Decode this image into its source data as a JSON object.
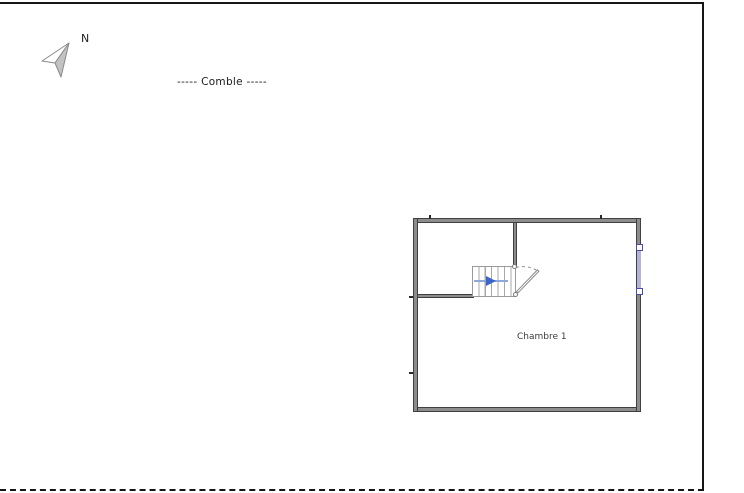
{
  "canvas": {
    "background": "#ffffff",
    "frame_color": "#161616"
  },
  "compass": {
    "label": "N"
  },
  "floor": {
    "title": "----- Comble -----"
  },
  "plan": {
    "rooms": [
      {
        "name": "Chambre 1"
      }
    ],
    "colors": {
      "wall_fill": "#8c8c8c",
      "wall_edge": "#404040",
      "stair_tread": "#a8a8a8",
      "stair_arrow_blue": "#3a66cc",
      "window_fill": "#b4b4d8",
      "window_handle_border": "#4d4da8",
      "door_stroke": "#8a8a8a"
    }
  }
}
